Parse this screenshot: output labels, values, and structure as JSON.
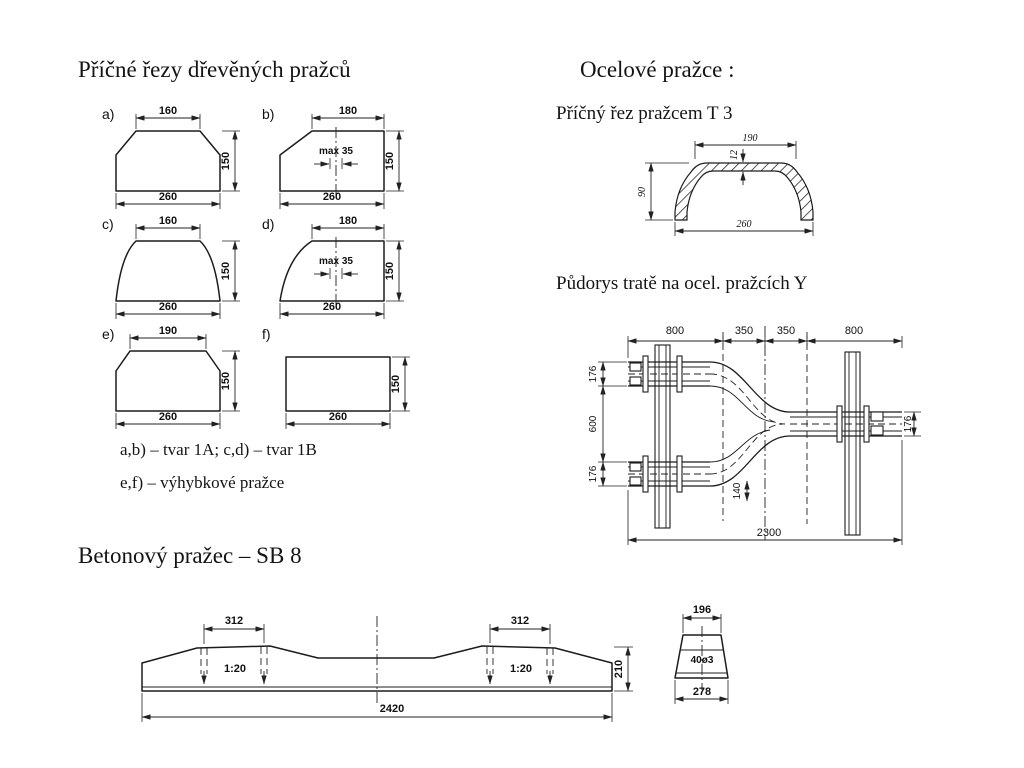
{
  "slide": {
    "title_wood": "Příčné řezy dřevěných pražců",
    "title_steel": "Ocelové pražce :",
    "subtitle_t3": "Příčný řez pražcem T 3",
    "subtitle_y": "Půdorys tratě na ocel. pražcích Y",
    "title_concrete": "Betonový pražec – SB 8",
    "caption_ab_cd": "a,b) – tvar 1A; c,d) – tvar 1B",
    "caption_ef": "e,f) – výhybkové pražce"
  },
  "wood": {
    "a": {
      "label": "a)",
      "top": "160",
      "height": "150",
      "bottom": "260"
    },
    "b": {
      "label": "b)",
      "top": "180",
      "height": "150",
      "bottom": "260",
      "note": "max 35"
    },
    "c": {
      "label": "c)",
      "top": "160",
      "height": "150",
      "bottom": "260"
    },
    "d": {
      "label": "d)",
      "top": "180",
      "height": "150",
      "bottom": "260",
      "note": "max 35"
    },
    "e": {
      "label": "e)",
      "top": "190",
      "height": "150",
      "bottom": "260"
    },
    "f": {
      "label": "f)",
      "height": "150",
      "bottom": "260"
    }
  },
  "t3": {
    "top": "190",
    "web": "12",
    "height": "90",
    "bottom": "260"
  },
  "y_plan": {
    "seg1": "800",
    "seg2": "350",
    "seg3": "350",
    "seg4": "800",
    "left_top": "176",
    "left_mid": "600",
    "left_bottom": "176",
    "right": "176",
    "offset": "140",
    "total": "2300"
  },
  "concrete": {
    "left_spacing": "312",
    "right_spacing": "312",
    "left_slope": "1:20",
    "right_slope": "1:20",
    "length": "2420",
    "height": "210"
  },
  "end_section": {
    "top": "196",
    "holes": "40ø3",
    "bottom": "278"
  },
  "colors": {
    "ink": "#1a1a1a",
    "paper": "#ffffff"
  }
}
